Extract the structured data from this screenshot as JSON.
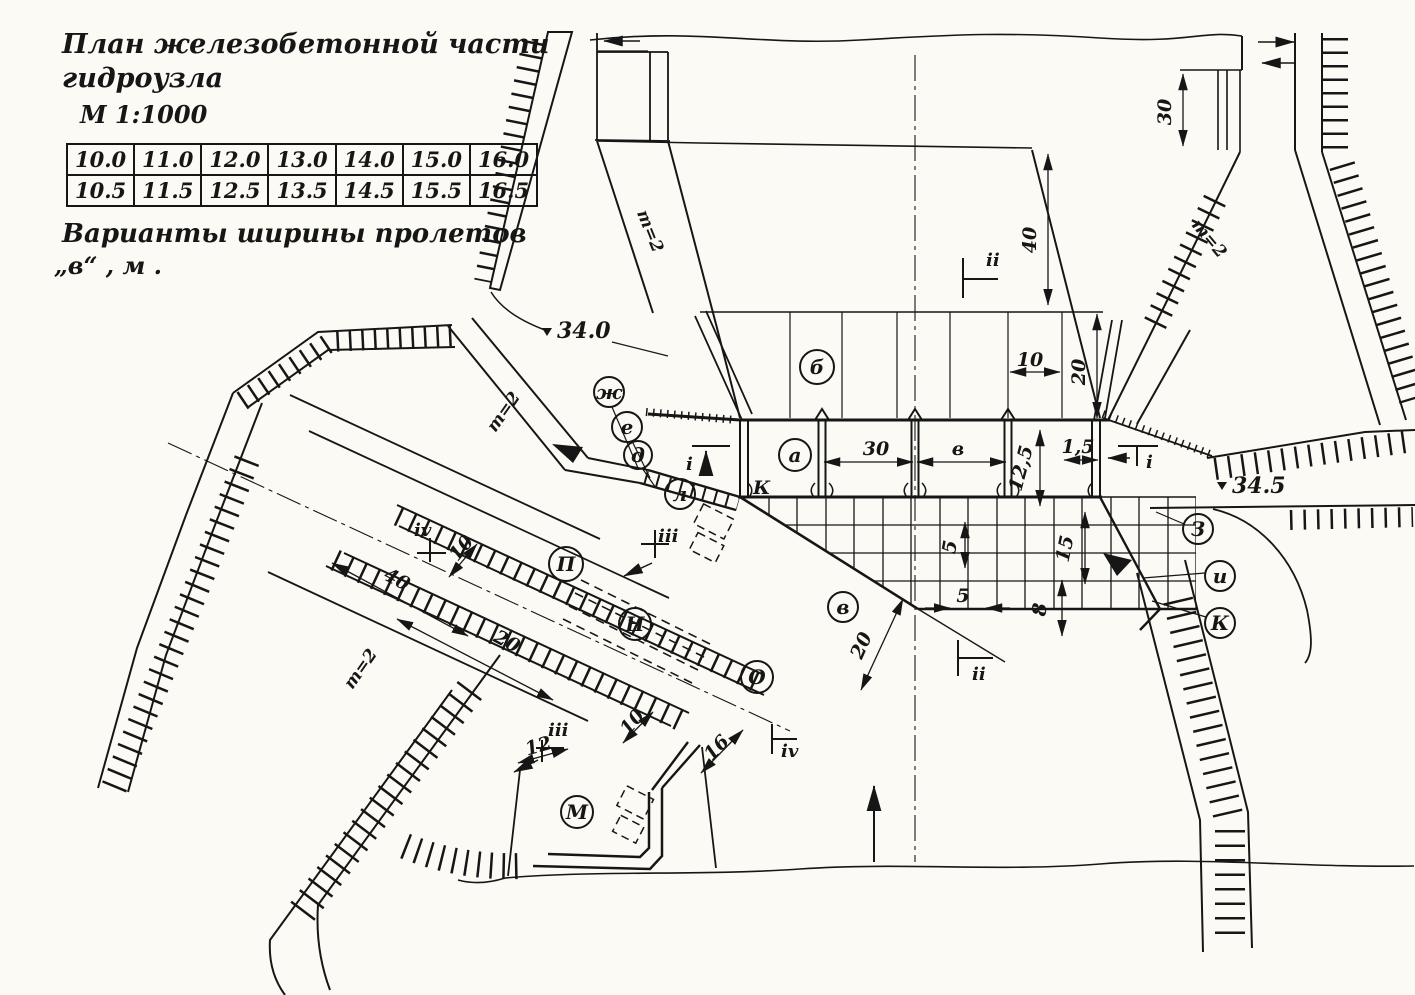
{
  "title_block": {
    "line1": "План железобетонной части",
    "line2": "гидроузла",
    "scale": "М 1:1000",
    "caption_line1": "Варианты ширины пролетов",
    "caption_line2": "„в“ , м .",
    "span_table": {
      "row1": [
        "10.0",
        "11.0",
        "12.0",
        "13.0",
        "14.0",
        "15.0",
        "16.0"
      ],
      "row2": [
        "10.5",
        "11.5",
        "12.5",
        "13.5",
        "14.5",
        "15.5",
        "16.5"
      ]
    }
  },
  "elevations": {
    "upstream": "34.0",
    "downstream": "34.5"
  },
  "slope_labels": {
    "top_left": "m=2",
    "top_right": "m=2",
    "channel": "m=2",
    "lower_left": "m=2"
  },
  "circled_labels": {
    "a": "а",
    "b": "б",
    "v": "в",
    "zh": "ж",
    "e": "е",
    "d": "д",
    "l": "л",
    "P": "П",
    "N": "Н",
    "O": "О",
    "M": "М",
    "Z": "З",
    "i": "и",
    "K": "К"
  },
  "gate_label": "К",
  "section_markers": {
    "i": "i",
    "ii": "ii",
    "iii": "iii",
    "iv": "iv"
  },
  "dimensions": {
    "top_pool_width": "40",
    "top_right_berm": "30",
    "apron_top": "10",
    "apron_len": "20",
    "pier_spacing": "30",
    "span": "в",
    "dam_len": "12,5",
    "pier_nose": "1,5",
    "cell_v": "5",
    "cell_h": "5",
    "end_sill": "8",
    "basin_len": "15",
    "diag": "20",
    "lock_40": "40",
    "lock_20": "20",
    "lock_10a": "10",
    "lock_10b": "10",
    "lock_12": "12",
    "lock_16": "16"
  }
}
